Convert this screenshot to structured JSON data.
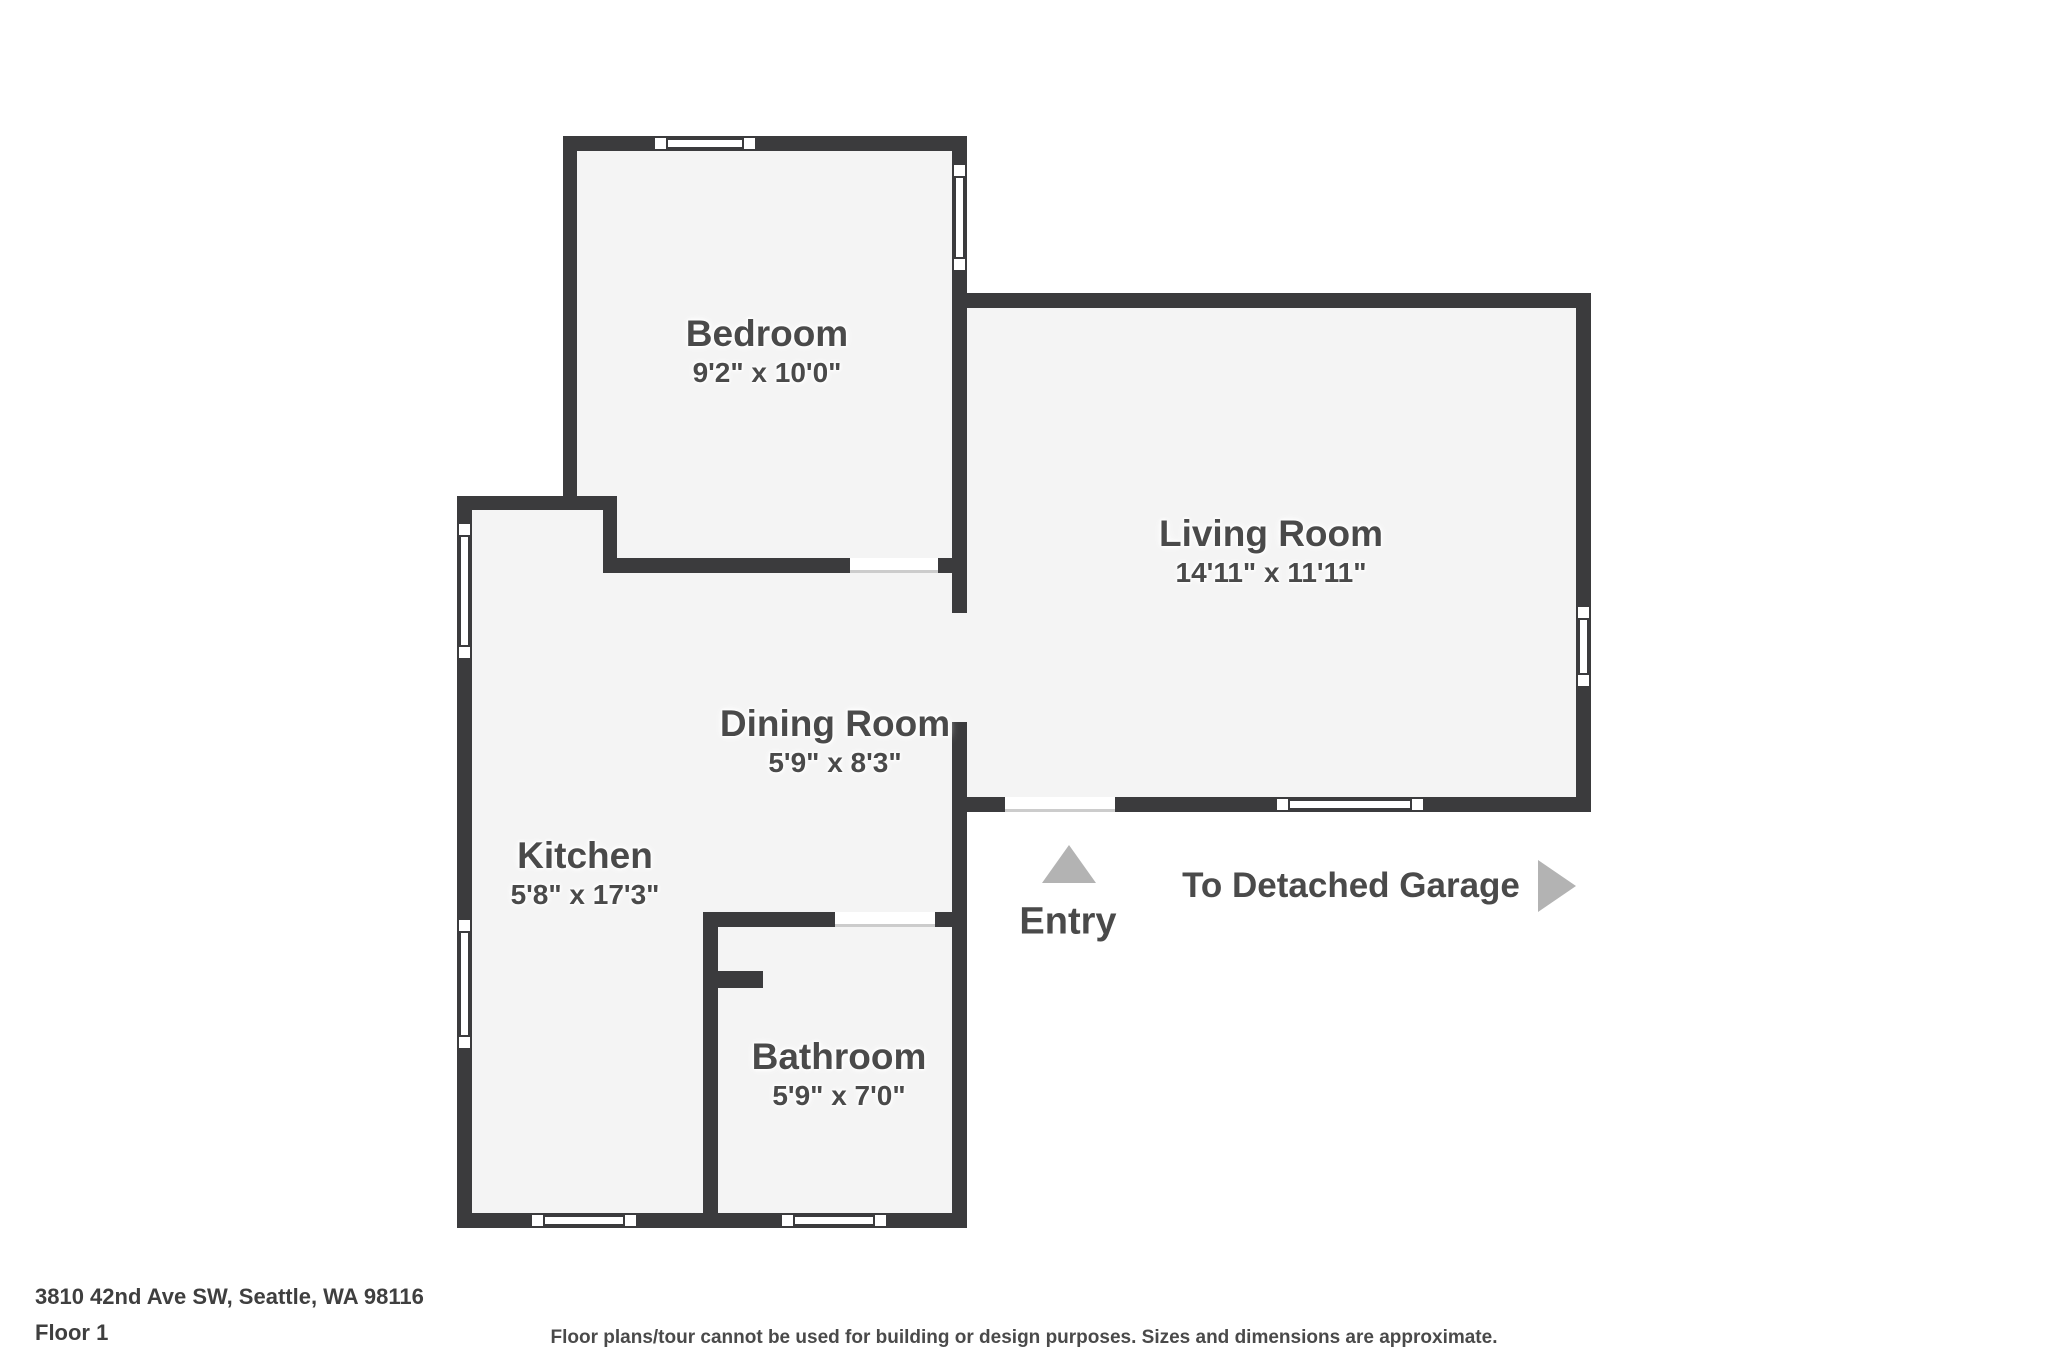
{
  "colors": {
    "wall": "#3b3b3d",
    "floor": "#f4f4f4",
    "label": "#4a4a4a",
    "marker": "#b3b3b3",
    "door_line": "#cccccc",
    "outside": "#ffffff"
  },
  "rooms": {
    "bedroom": {
      "name": "Bedroom",
      "dims": "9'2\" x 10'0\""
    },
    "living_room": {
      "name": "Living Room",
      "dims": "14'11\" x 11'11\""
    },
    "dining_room": {
      "name": "Dining Room",
      "dims": "5'9\" x 8'3\""
    },
    "kitchen": {
      "name": "Kitchen",
      "dims": "5'8\" x 17'3\""
    },
    "bathroom": {
      "name": "Bathroom",
      "dims": "5'9\" x 7'0\""
    }
  },
  "markers": {
    "entry": {
      "label": "Entry"
    },
    "garage": {
      "label": "To Detached Garage"
    }
  },
  "footer": {
    "address": "3810 42nd Ave SW, Seattle, WA 98116",
    "floor": "Floor 1",
    "disclaimer": "Floor plans/tour cannot be used for building or design purposes. Sizes and dimensions are approximate."
  }
}
